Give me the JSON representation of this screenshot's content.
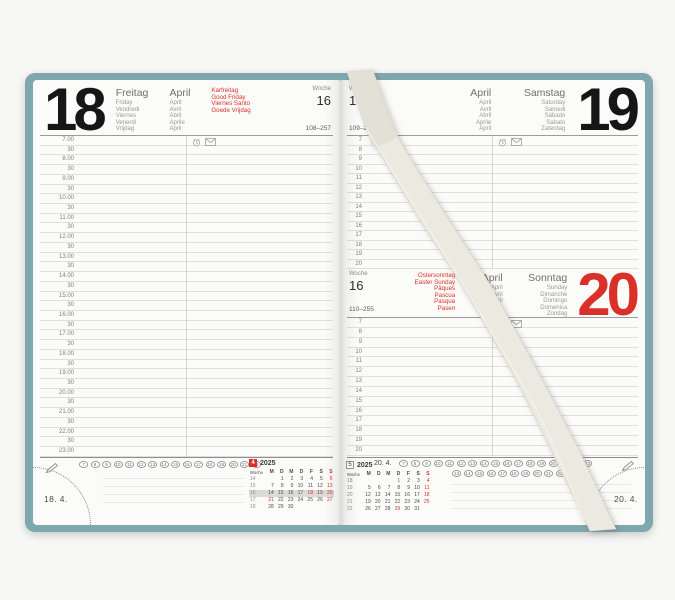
{
  "left_page": {
    "day_number": "18",
    "day_names": [
      "Freitag",
      "Friday",
      "Vendredi",
      "Viernes",
      "Venerdì",
      "Vrijdag"
    ],
    "month_names": [
      "April",
      "April",
      "Avril",
      "Abril",
      "Aprile",
      "April"
    ],
    "holiday_lines": [
      "Karfreitag",
      "Good Friday",
      "",
      "Viernes Santo",
      "",
      "Goede Vrijdag"
    ],
    "week_label": "Woche",
    "week_number": "16",
    "day_count": "108–257",
    "time_rows": [
      "7.00",
      "30",
      "8.00",
      "30",
      "9.00",
      "30",
      "10.00",
      "30",
      "11.00",
      "30",
      "12.00",
      "30",
      "13.00",
      "30",
      "14.00",
      "30",
      "15.00",
      "30",
      "16.00",
      "30",
      "17.00",
      "30",
      "18.00",
      "30",
      "19.00",
      "30",
      "20.00",
      "30",
      "21.00",
      "30",
      "22.00",
      "30",
      "23.00"
    ],
    "circled_numbers": [
      "7",
      "8",
      "9",
      "10",
      "11",
      "12",
      "13",
      "14",
      "15",
      "16",
      "17",
      "18",
      "19",
      "20",
      "21",
      "22"
    ],
    "corner_date": "18. 4."
  },
  "right_page_top": {
    "week_label": "Woche",
    "week_number": "16",
    "day_count": "109–256",
    "month_names": [
      "April",
      "April",
      "Avril",
      "Abril",
      "Aprile",
      "April"
    ],
    "day_names": [
      "Samstag",
      "Saturday",
      "Samedi",
      "Sábado",
      "Sabato",
      "Zaterdag"
    ],
    "day_number": "19",
    "hour_rows": [
      "7",
      "8",
      "9",
      "10",
      "11",
      "12",
      "13",
      "14",
      "15",
      "16",
      "17",
      "18",
      "19",
      "20"
    ]
  },
  "right_page_bottom": {
    "week_label": "Woche",
    "week_number": "16",
    "day_count": "110–255",
    "holiday_lines": [
      "Ostersonntag",
      "Easter Sunday",
      "Pâques",
      "Pascua",
      "Pasqua",
      "Pasen"
    ],
    "month_names": [
      "April",
      "April",
      "Avril",
      "Abril",
      "Aprile",
      "April"
    ],
    "day_names": [
      "Sonntag",
      "Sunday",
      "Dimanche",
      "Domingo",
      "Domenica",
      "Zondag"
    ],
    "day_number": "20",
    "hour_rows": [
      "7",
      "8",
      "9",
      "10",
      "11",
      "12",
      "13",
      "14",
      "15",
      "16",
      "17",
      "18",
      "19",
      "20"
    ]
  },
  "right_footer": {
    "date_label": "20. 4.",
    "circles_row1": [
      "7",
      "8",
      "9",
      "10",
      "11",
      "12",
      "13",
      "14",
      "15",
      "16",
      "17",
      "18",
      "19",
      "20",
      "21",
      "22",
      "23"
    ],
    "circles_row2": [
      "13",
      "14",
      "15",
      "16",
      "17",
      "18",
      "19",
      "20",
      "21",
      "22",
      "23"
    ],
    "corner_date": "20. 4."
  },
  "calendar_april": {
    "month_number": "4",
    "year": "2025",
    "is_current_month": true,
    "week_label": "Woche",
    "day_headers": [
      "M",
      "D",
      "M",
      "D",
      "F",
      "S",
      "S"
    ],
    "weeks": [
      {
        "week": "14",
        "days": [
          "",
          "1",
          "2",
          "3",
          "4",
          "5",
          "6"
        ],
        "red_days": [
          "6"
        ],
        "highlight": false
      },
      {
        "week": "15",
        "days": [
          "7",
          "8",
          "9",
          "10",
          "11",
          "12",
          "13"
        ],
        "red_days": [
          "13"
        ],
        "highlight": false
      },
      {
        "week": "16",
        "days": [
          "14",
          "15",
          "16",
          "17",
          "18",
          "19",
          "20"
        ],
        "red_days": [
          "18",
          "20"
        ],
        "highlight": true
      },
      {
        "week": "17",
        "days": [
          "21",
          "22",
          "23",
          "24",
          "25",
          "26",
          "27"
        ],
        "red_days": [
          "21",
          "27"
        ],
        "highlight": false
      },
      {
        "week": "18",
        "days": [
          "28",
          "29",
          "30",
          "",
          "",
          "",
          ""
        ],
        "red_days": [],
        "highlight": false
      }
    ]
  },
  "calendar_may": {
    "month_number": "5",
    "year": "2025",
    "is_current_month": false,
    "week_label": "Woche",
    "day_headers": [
      "M",
      "D",
      "M",
      "D",
      "F",
      "S",
      "S"
    ],
    "weeks": [
      {
        "week": "18",
        "days": [
          "",
          "",
          "",
          "1",
          "2",
          "3",
          "4"
        ],
        "red_days": [
          "1",
          "4"
        ],
        "highlight": false
      },
      {
        "week": "19",
        "days": [
          "5",
          "6",
          "7",
          "8",
          "9",
          "10",
          "11"
        ],
        "red_days": [
          "11"
        ],
        "highlight": false
      },
      {
        "week": "20",
        "days": [
          "12",
          "13",
          "14",
          "15",
          "16",
          "17",
          "18"
        ],
        "red_days": [
          "18"
        ],
        "highlight": false
      },
      {
        "week": "21",
        "days": [
          "19",
          "20",
          "21",
          "22",
          "23",
          "24",
          "25"
        ],
        "red_days": [
          "25"
        ],
        "highlight": false
      },
      {
        "week": "22",
        "days": [
          "26",
          "27",
          "28",
          "29",
          "30",
          "31",
          ""
        ],
        "red_days": [
          "29"
        ],
        "highlight": false
      }
    ]
  },
  "colors": {
    "cover": "#7fa7ae",
    "accent_red": "#d9302a",
    "page": "#fbfbf9"
  }
}
